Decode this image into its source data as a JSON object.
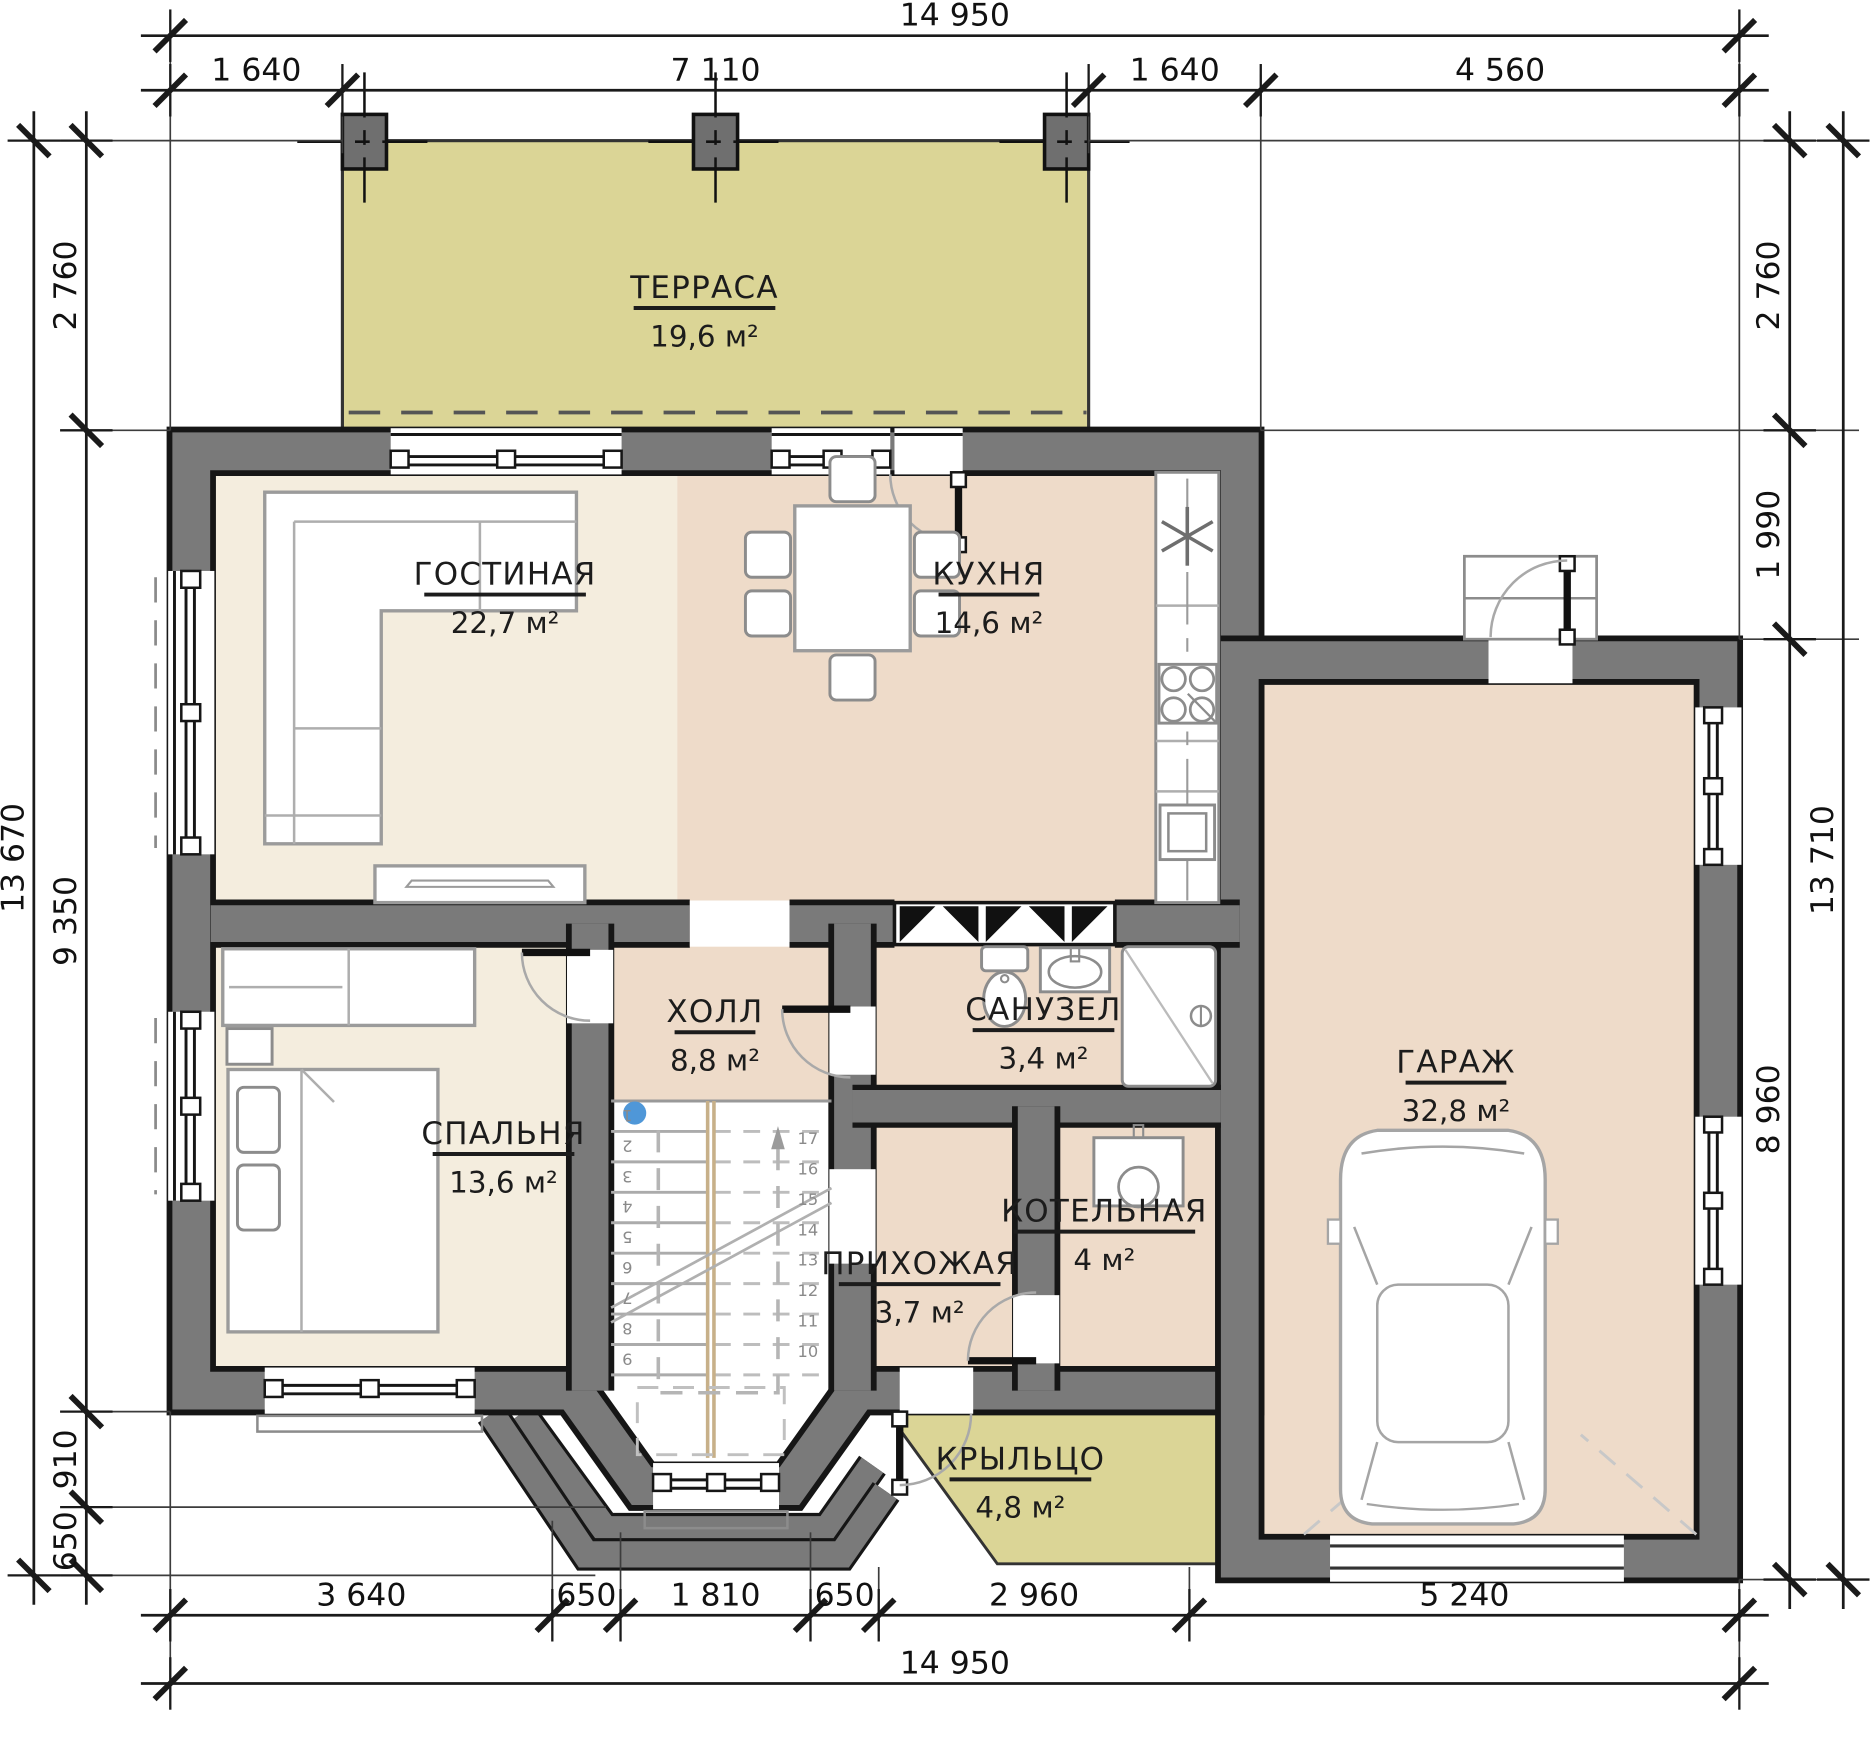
{
  "drawing": {
    "type": "architectural-floor-plan",
    "colors": {
      "wall_gray": "#7a7a7a",
      "wall_outline": "#161616",
      "terrace_khaki": "#dbd596",
      "room_cream": "#f4edde",
      "room_pink": "#eedbc9",
      "stair_marker_blue": "#4f97d8",
      "background": "#ffffff"
    },
    "rooms": [
      {
        "id": "terrasa",
        "name": "ТЕРРАСА",
        "area": "19,6 м²",
        "x": 5090,
        "y": 1500,
        "w": 1350
      },
      {
        "id": "gostinaya",
        "name": "ГОСТИНАЯ",
        "area": "22,7 м²",
        "x": 3190,
        "y": 4230,
        "w": 1540
      },
      {
        "id": "kuhnya",
        "name": "КУХНЯ",
        "area": "14,6 м²",
        "x": 7800,
        "y": 4230,
        "w": 960
      },
      {
        "id": "holl",
        "name": "ХОЛЛ",
        "area": "8,8 м²",
        "x": 5190,
        "y": 8400,
        "w": 770
      },
      {
        "id": "sanuzel",
        "name": "САНУЗЕЛ",
        "area": "3,4 м²",
        "x": 8320,
        "y": 8380,
        "w": 1350
      },
      {
        "id": "spalnya",
        "name": "СПАЛЬНЯ",
        "area": "13,6 м²",
        "x": 3175,
        "y": 9560,
        "w": 1350
      },
      {
        "id": "prihozhaya",
        "name": "ПРИХОЖАЯ",
        "area": "3,7 м²",
        "x": 7140,
        "y": 10800,
        "w": 1540
      },
      {
        "id": "kotelnaya",
        "name": "КОТЕЛЬНАЯ",
        "area": "4 м²",
        "x": 8900,
        "y": 10300,
        "w": 1730
      },
      {
        "id": "garazh",
        "name": "ГАРАЖ",
        "area": "32,8 м²",
        "x": 12250,
        "y": 8880,
        "w": 960
      },
      {
        "id": "krylco",
        "name": "КРЫЛЬЦО",
        "area": "4,8 м²",
        "x": 8100,
        "y": 12660,
        "w": 1350
      }
    ],
    "dimensions": {
      "horizontal": [
        {
          "y": -1000,
          "ticks": [
            0,
            14950
          ],
          "labels": [
            {
              "text": "14 950",
              "x": 7475
            }
          ]
        },
        {
          "y": -480,
          "ticks": [
            0,
            1640,
            8750,
            10390,
            14950
          ],
          "labels": [
            {
              "text": "1 640",
              "x": 820
            },
            {
              "text": "7 110",
              "x": 5195
            },
            {
              "text": "1 640",
              "x": 9570
            },
            {
              "text": "4 560",
              "x": 12670
            }
          ]
        },
        {
          "y": 14050,
          "ticks": [
            0,
            3640,
            4290,
            6100,
            6750,
            9710,
            14950
          ],
          "labels": [
            {
              "text": "3 640",
              "x": 1820
            },
            {
              "text": "650",
              "x": 3965
            },
            {
              "text": "1 810",
              "x": 5195
            },
            {
              "text": "650",
              "x": 6425
            },
            {
              "text": "2 960",
              "x": 8230
            },
            {
              "text": "5 240",
              "x": 12330
            }
          ]
        },
        {
          "y": 14700,
          "ticks": [
            0,
            14950
          ],
          "labels": [
            {
              "text": "14 950",
              "x": 7475
            }
          ]
        }
      ],
      "vertical": [
        {
          "x": -1300,
          "ticks": [
            0,
            13670
          ],
          "labels": [
            {
              "text": "13 670",
              "y": 6835
            }
          ]
        },
        {
          "x": -800,
          "ticks": [
            0,
            2760,
            12110,
            13020,
            13670
          ],
          "labels": [
            {
              "text": "2 760",
              "y": 1380
            },
            {
              "text": "9 350",
              "y": 7435
            },
            {
              "text": "910",
              "y": 12565
            },
            {
              "text": "650",
              "y": 13345
            }
          ]
        },
        {
          "x": 15430,
          "ticks": [
            0,
            2760,
            4750,
            13710
          ],
          "labels": [
            {
              "text": "2 760",
              "y": 1380
            },
            {
              "text": "1 990",
              "y": 3755
            },
            {
              "text": "8 960",
              "y": 9230
            }
          ]
        },
        {
          "x": 15940,
          "ticks": [
            0,
            13710
          ],
          "labels": [
            {
              "text": "13 710",
              "y": 6855
            }
          ]
        }
      ]
    },
    "stairs": {
      "left_steps": [
        "1",
        "2",
        "3",
        "4",
        "5",
        "6",
        "7",
        "8",
        "9"
      ],
      "right_steps": [
        "17",
        "16",
        "15",
        "14",
        "13",
        "12",
        "11",
        "10"
      ]
    }
  }
}
